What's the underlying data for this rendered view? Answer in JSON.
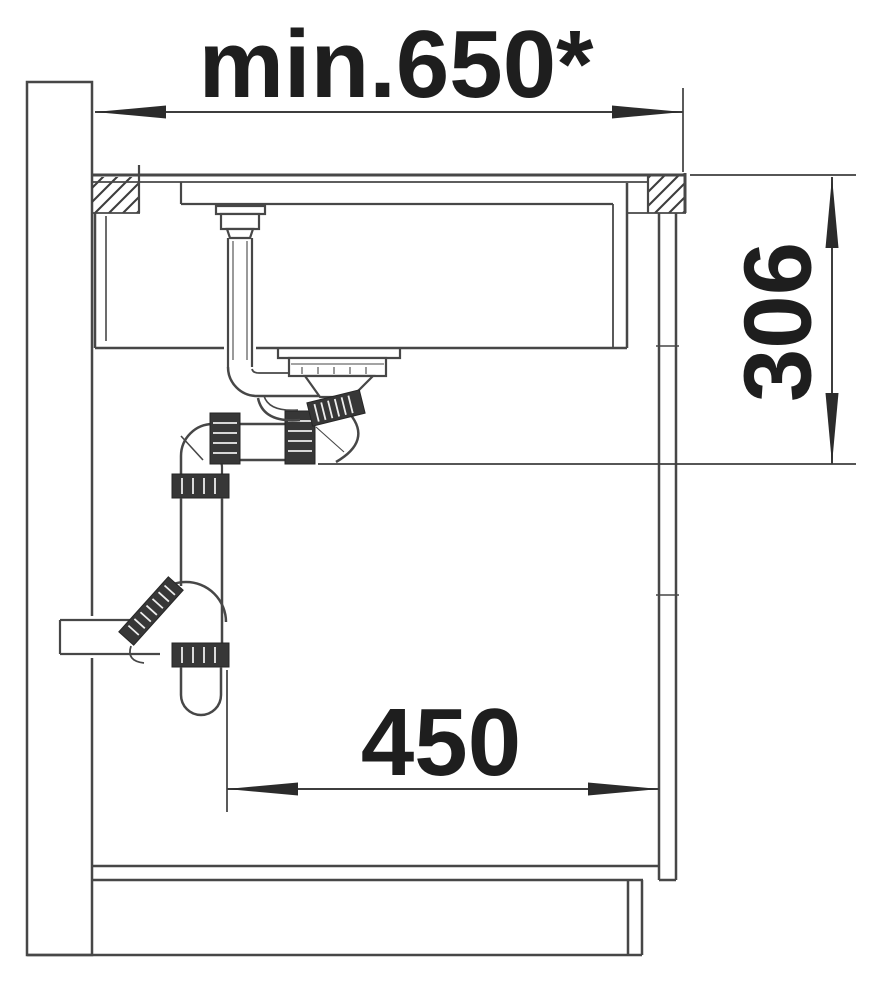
{
  "diagram": {
    "labels": {
      "top_dimension": "min.650*",
      "right_dimension": "306",
      "bottom_dimension": "450"
    },
    "colors": {
      "line": "#474747",
      "text": "#1e1e1e",
      "background": "#ffffff",
      "fitting_fill": "#373737"
    }
  }
}
